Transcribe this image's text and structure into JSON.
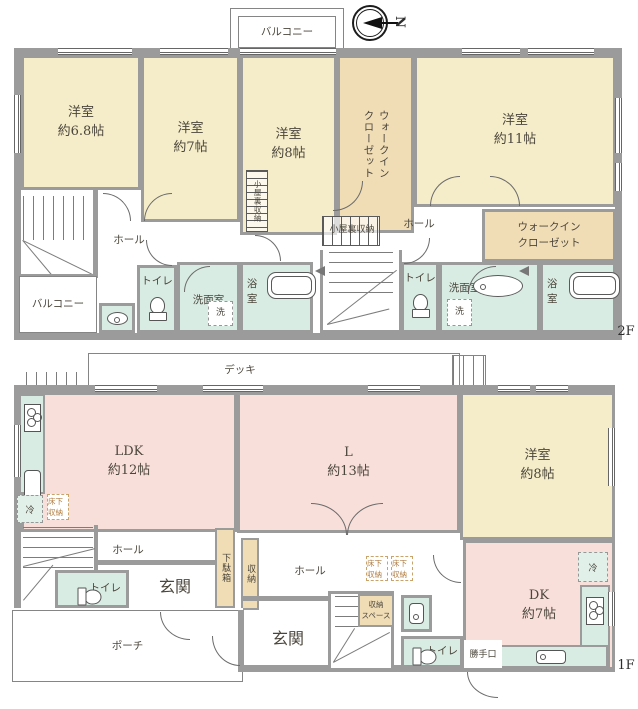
{
  "f2": {
    "floor_tag": "2F",
    "compass_n": "N",
    "balcony_top": "バルコニー",
    "balcony_left": "バルコニー",
    "room_68": "洋室\n約6.8帖",
    "room_7": "洋室\n約7帖",
    "room_8": "洋室\n約8帖",
    "room_11": "洋室\n約11帖",
    "wic_left": "ウォークイン\nクローゼット",
    "wic_right": "ウォークイン\nクローゼット",
    "attic_small": "小屋裏収納",
    "attic_mid": "小屋裏収納",
    "hall_left": "ホール",
    "hall_right": "ホール",
    "toilet_left": "トイレ",
    "toilet_right": "トイレ",
    "wash_left": "洗面室",
    "wash_right": "洗面室",
    "laundry_left": "洗",
    "laundry_right": "洗",
    "bath_left": "浴室",
    "bath_right": "浴室"
  },
  "f1": {
    "floor_tag": "1F",
    "deck": "デッキ",
    "ldk": "LDK\n約12帖",
    "living": "L\n約13帖",
    "room_8": "洋室\n約8帖",
    "dk": "DK\n約7帖",
    "fridge_left": "冷",
    "fridge_right": "冷",
    "underfloor_left": "床下\n収納",
    "underfloor_mid1": "床下\n収納",
    "underfloor_mid2": "床下\n収納",
    "hall_left": "ホール",
    "hall_mid": "ホール",
    "entrance_left": "玄関",
    "entrance_mid": "玄関",
    "shoe_box": "下駄箱",
    "storage": "収納",
    "storage_space": "収納\nスペース",
    "toilet_left": "トイレ",
    "toilet_right": "トイレ",
    "porch": "ポーチ",
    "back_door": "勝手口"
  }
}
